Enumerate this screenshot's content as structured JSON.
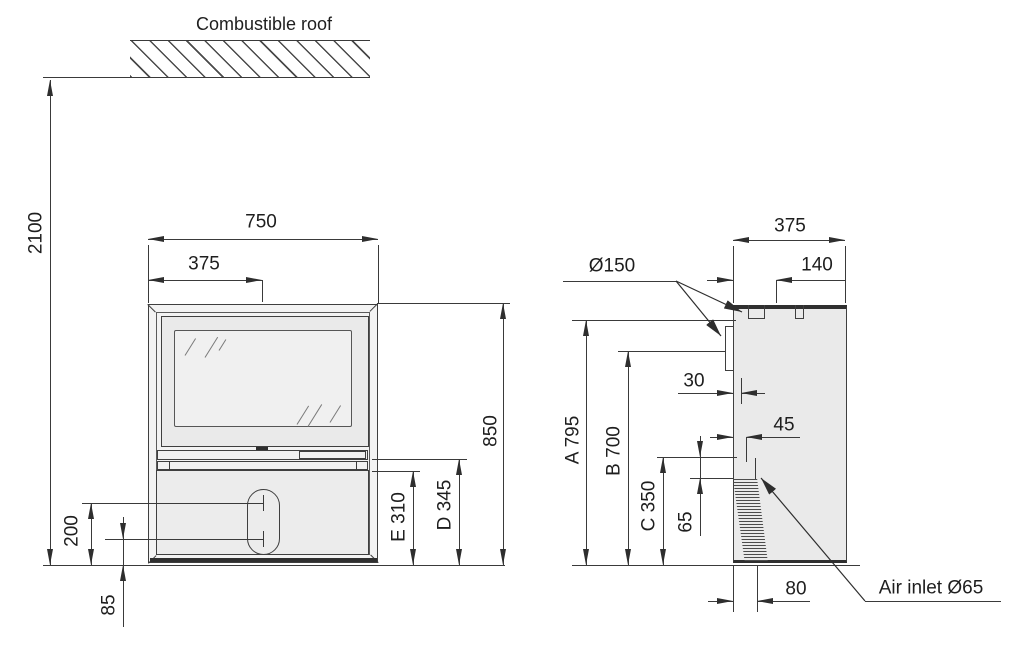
{
  "roof": {
    "label": "Combustible roof",
    "clearance": "2100"
  },
  "front_view": {
    "width": "750",
    "half_width": "375",
    "height": "850",
    "dim_d": "D 345",
    "dim_e": "E 310",
    "knob_upper_height": "200",
    "knob_lower_height": "85"
  },
  "side_view": {
    "depth": "375",
    "flue_center_offset": "140",
    "flue_diameter": "Ø150",
    "dim_a": "A 795",
    "dim_b": "B 700",
    "dim_c": "C 350",
    "rear_flue_offset": "30",
    "air_top_offset": "45",
    "air_gap": "65",
    "air_bottom_offset": "80",
    "air_inlet": "Air inlet Ø65"
  },
  "colors": {
    "line": "#3a3a3a",
    "body_fill": "#ebebeb",
    "glass_fill": "#f0f0f0",
    "background": "#ffffff"
  }
}
